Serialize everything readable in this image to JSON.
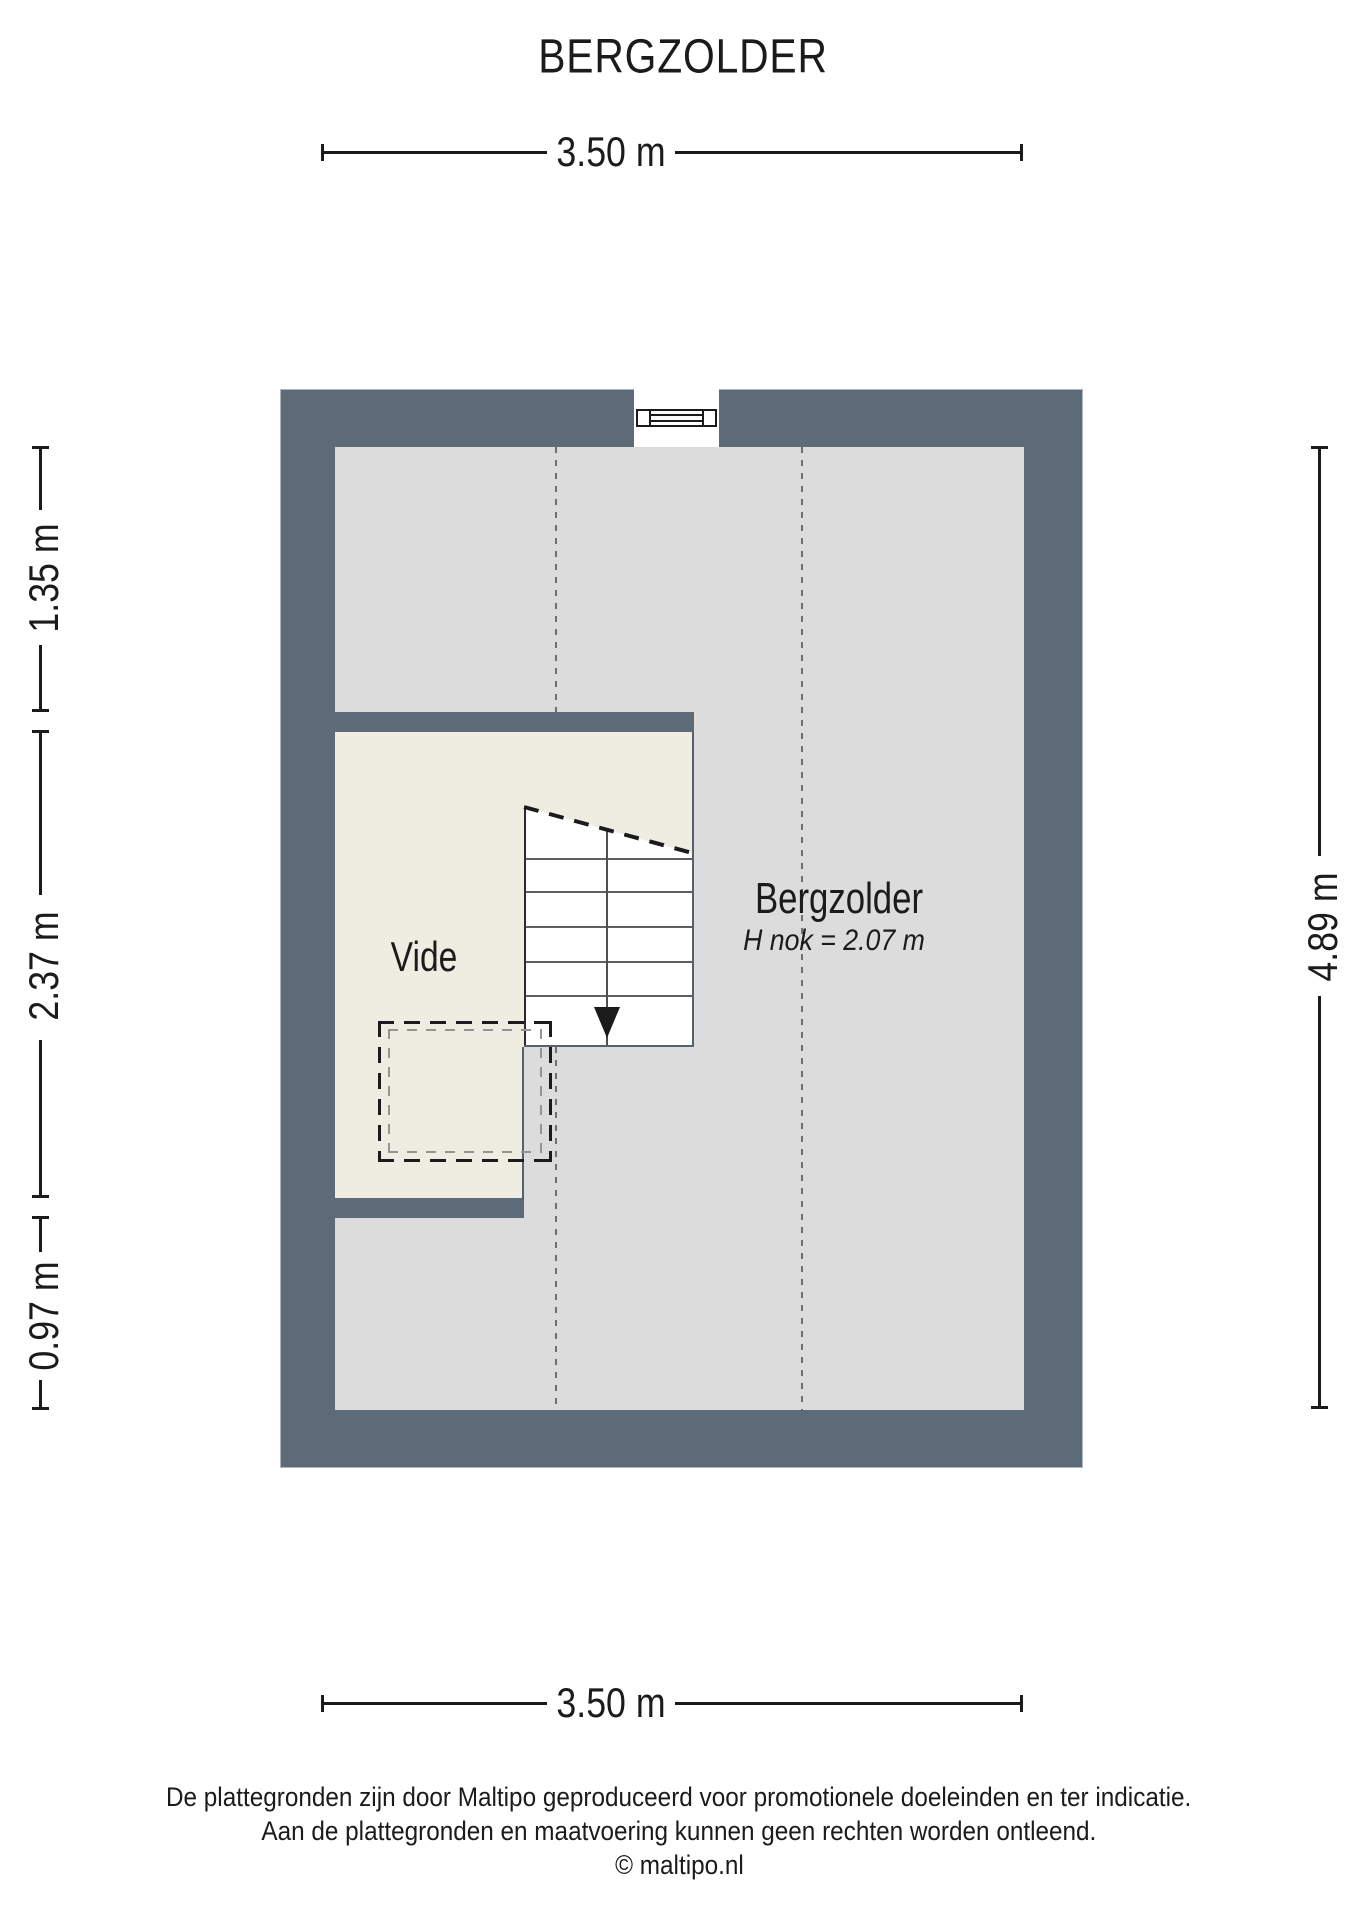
{
  "title": "BERGZOLDER",
  "dimensions": {
    "top": "3.50 m",
    "bottom": "3.50 m",
    "left_top": "1.35 m",
    "left_middle": "2.37 m",
    "left_bottom": "0.97 m",
    "right": "4.89 m"
  },
  "plan": {
    "room_label": "Bergzolder",
    "room_height_note": "H nok = 2.07 m",
    "vide_label": "Vide"
  },
  "footer": {
    "line1": "De plattegronden zijn door Maltipo geproduceerd voor promotionele doeleinden en ter indicatie.",
    "line2": "Aan de plattegronden en maatvoering kunnen geen rechten worden ontleend.",
    "line3": "© maltipo.nl"
  },
  "colors": {
    "wall": "#5c6b77",
    "floor": "#dcdcdc",
    "vide_floor": "#efece2",
    "stair": "#ffffff",
    "line": "#1b1b1b"
  }
}
